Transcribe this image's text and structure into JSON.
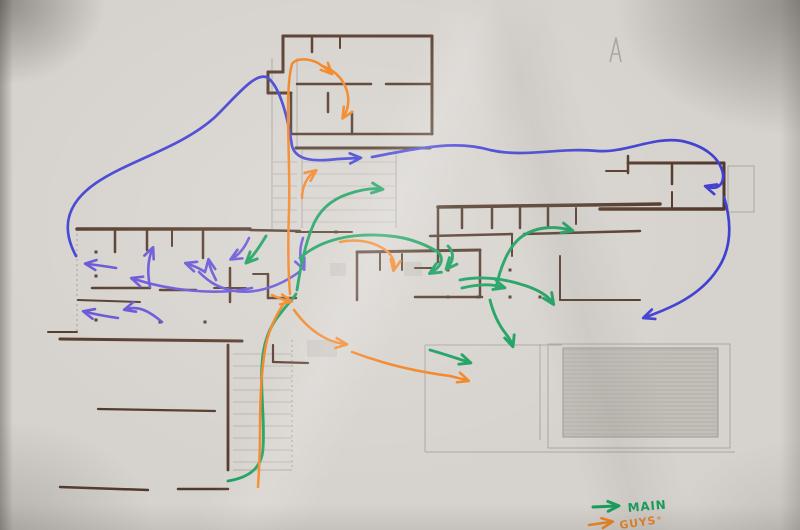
{
  "legend": {
    "items": [
      {
        "id": "main-route",
        "label": "MAIN",
        "color_key": "green"
      },
      {
        "id": "guys-route",
        "label": "GUYS⁺",
        "color_key": "orange"
      }
    ]
  },
  "annotations": {
    "north_mark": "A"
  },
  "colors": {
    "paper": "#d6d2cd",
    "wall": "#53392a",
    "pencil": "#aaa59f",
    "blue": "#4041d2",
    "violet": "#6552d6",
    "green": "#149d5b",
    "orange": "#f2801c"
  }
}
